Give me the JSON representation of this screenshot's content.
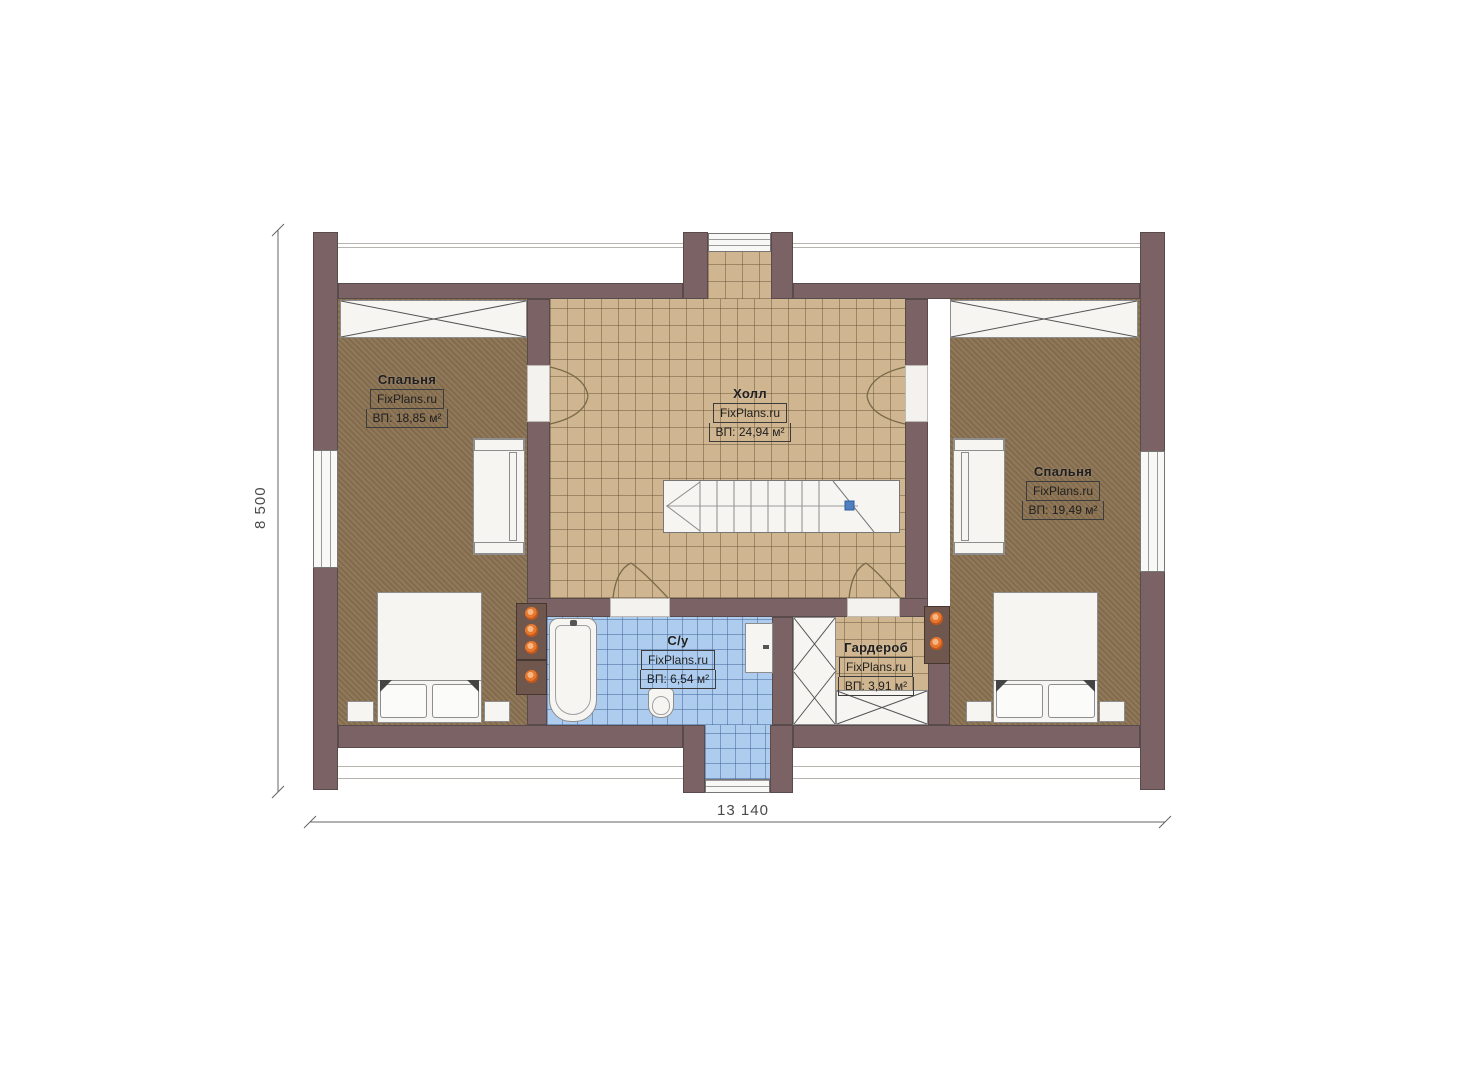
{
  "watermark": "FixPlans.ru",
  "rooms": {
    "bedroom_left": {
      "name": "Спальня",
      "area": "ВП: 18,85 м²"
    },
    "hall": {
      "name": "Холл",
      "area": "ВП: 24,94 м²"
    },
    "bedroom_right": {
      "name": "Спальня",
      "area": "ВП: 19,49 м²"
    },
    "bathroom": {
      "name": "С/у",
      "area": "ВП: 6,54 м²"
    },
    "wardrobe": {
      "name": "Гардероб",
      "area": "ВП: 3,91 м²"
    }
  },
  "dimensions": {
    "horizontal": "13 140",
    "vertical": "8 500"
  },
  "colors": {
    "wall": "#7b6365",
    "hall_floor": "#cfb590",
    "bedroom_floor": "#8c7353",
    "bathroom_floor": "#aecdee",
    "flue_dot": "#e8772e",
    "stair_marker": "#4f7fc0"
  }
}
